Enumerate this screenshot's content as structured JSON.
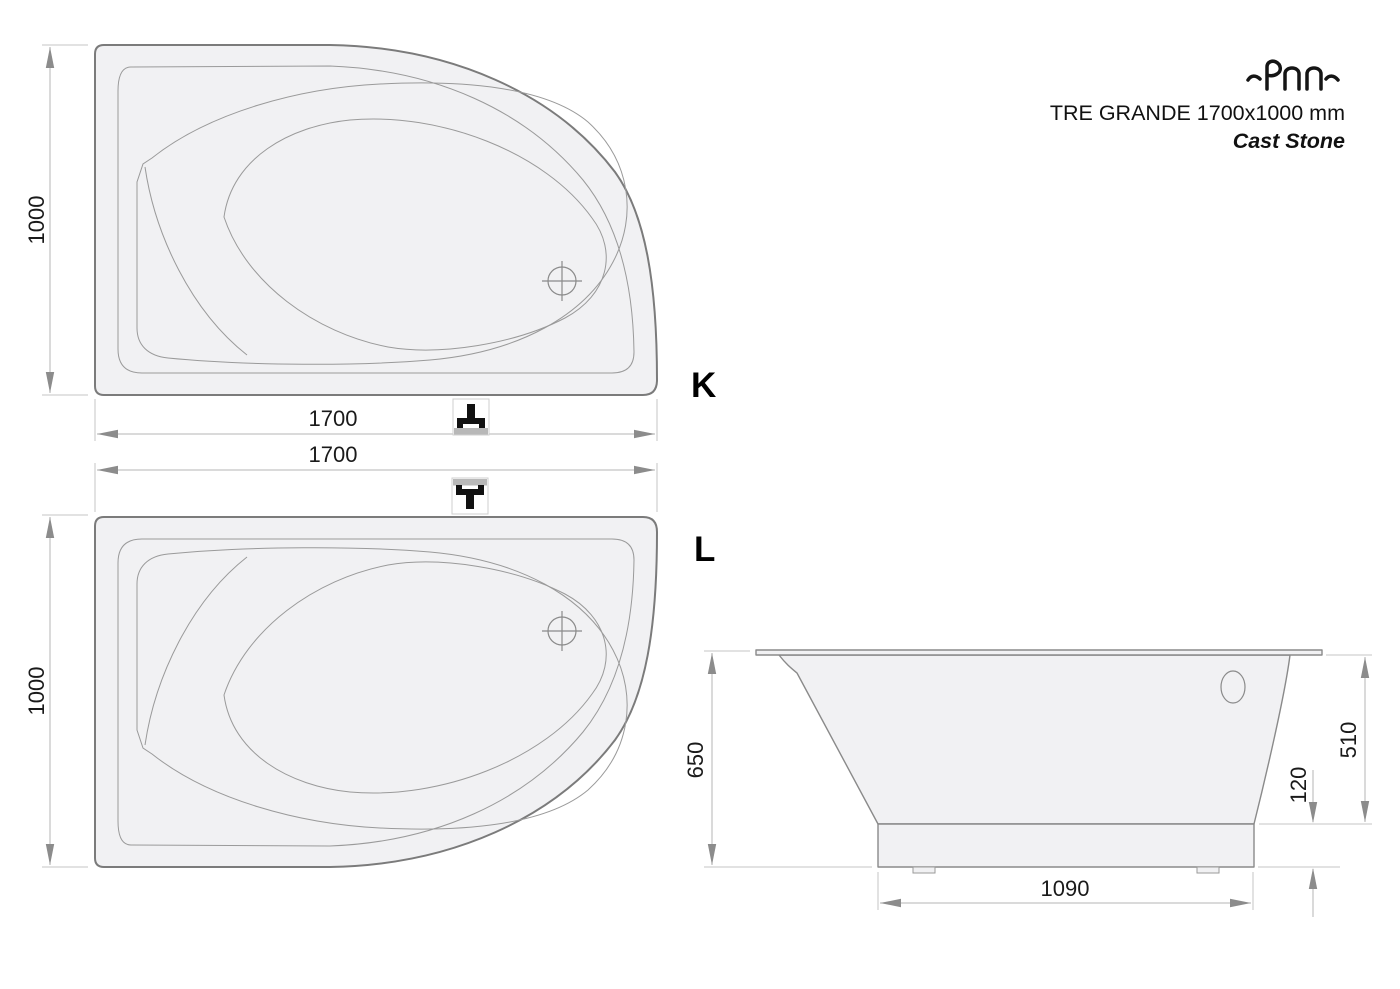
{
  "header": {
    "logo": "PAA",
    "product_title": "TRE GRANDE 1700x1000 mm",
    "material": "Cast Stone"
  },
  "plan_view_k": {
    "view_label": "K",
    "dim_length": "1700",
    "dim_width": "1000"
  },
  "plan_view_l": {
    "view_label": "L",
    "dim_length": "1700",
    "dim_width": "1000"
  },
  "side_view": {
    "dim_total_height": "650",
    "dim_rim_to_base": "510",
    "dim_base_height": "120",
    "dim_base_length": "1090"
  },
  "colors": {
    "tub_fill": "#f1f1f3",
    "tub_outline": "#7b7b7b",
    "tub_line": "#9a9a9a",
    "dim_line": "#b5b5b5",
    "ext_line": "#c5c5c5",
    "arrow": "#8c8c8c",
    "text": "#1a1a1a",
    "icon_band": "#b8b8b8"
  }
}
